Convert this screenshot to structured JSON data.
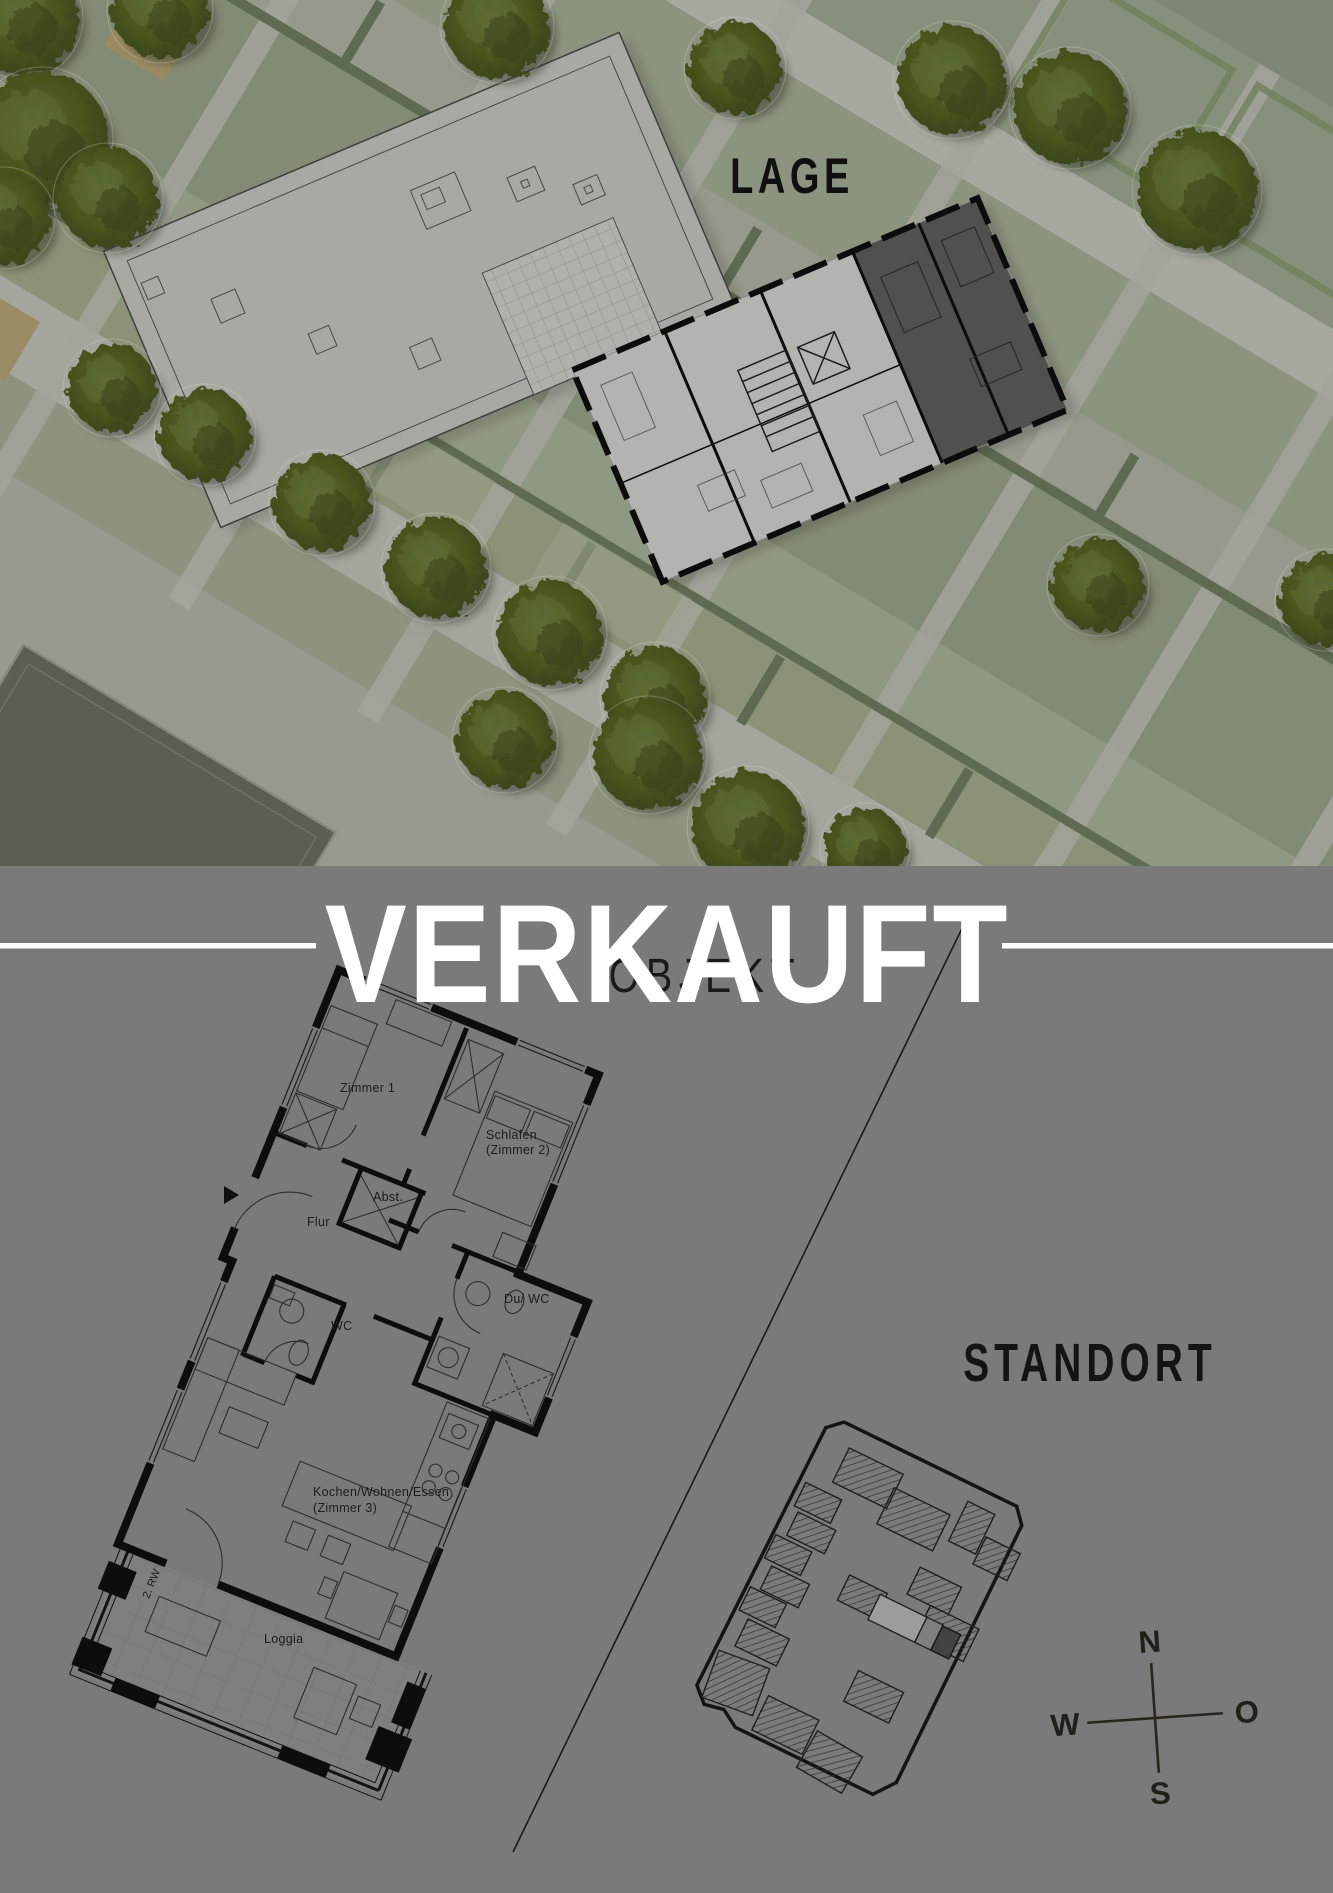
{
  "lage": {
    "title": "LAGE"
  },
  "banner": {
    "verkauft": "VERKAUFT"
  },
  "objekt": {
    "title": "OBJEKT",
    "rooms": {
      "zimmer1": "Zimmer 1",
      "schlafen_line1": "Schlafen",
      "schlafen_line2": "(Zimmer 2)",
      "abst": "Abst.",
      "flur": "Flur",
      "wc": "WC",
      "du_wc": "Du/ WC",
      "kochen_line1": "Kochen/Wohnen/Essen",
      "kochen_line2": "(Zimmer 3)",
      "loggia": "Loggia",
      "rettungsweg": "2. RW"
    }
  },
  "standort": {
    "title": "STANDORT"
  },
  "compass": {
    "north": "N",
    "south": "S",
    "west": "W",
    "east": "O"
  },
  "colors": {
    "background_gray": "#7a7a7a",
    "banner_text": "#ffffff",
    "plan_ink": "#0d0d0d",
    "sold_unit_dark": "#50504d",
    "lawn_green": "#828b75",
    "tree_green": "#49561f",
    "roof_gray": "#a8a9a3"
  }
}
